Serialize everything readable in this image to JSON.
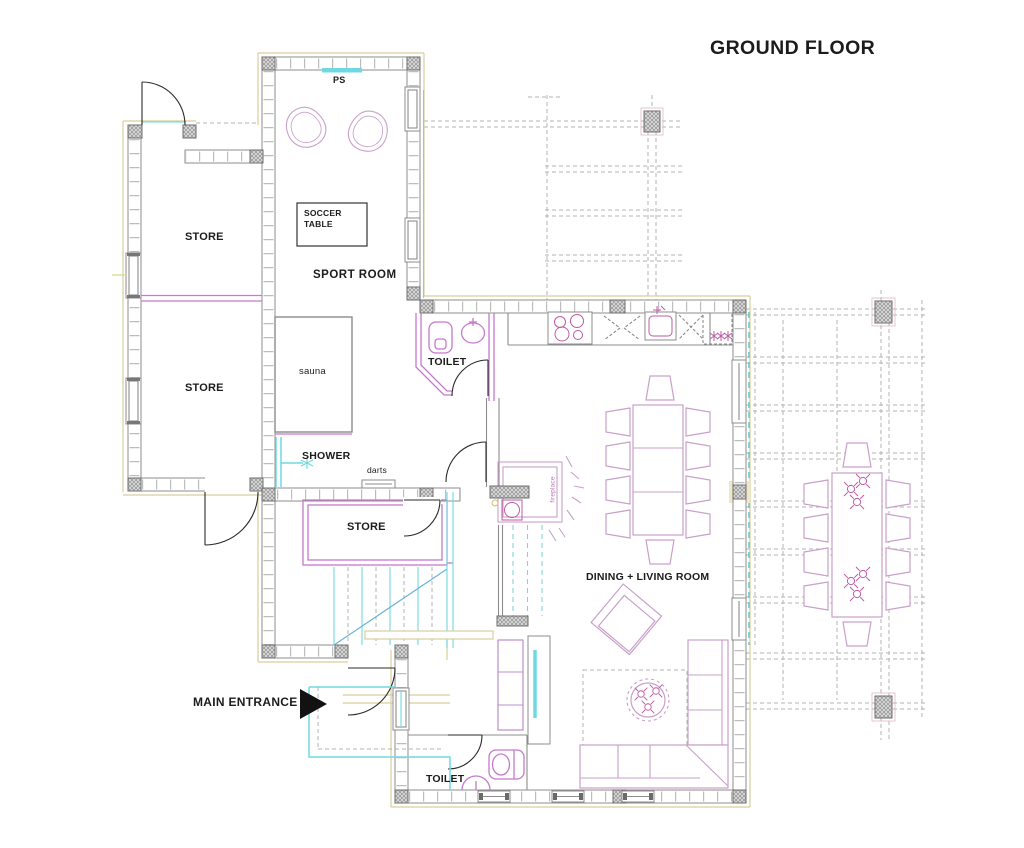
{
  "title": "GROUND FLOOR",
  "rooms": {
    "sport_room": "SPORT ROOM",
    "store_upper": "STORE",
    "store_middle": "STORE",
    "store_inner": "STORE",
    "sauna": "sauna",
    "toilet_upper": "TOILET",
    "toilet_lower": "TOILET",
    "dining_living": "DINING + LIVING ROOM"
  },
  "annotations": {
    "ps": "PS",
    "soccer_table": "SOCCER TABLE",
    "shower": "SHOWER",
    "darts": "darts",
    "fireplace": "fireplace",
    "main_entrance": "MAIN ENTRANCE"
  },
  "colors": {
    "wall": "#8c8c8c",
    "hatch": "#9a9a9a",
    "accent_tan": "#d9ce9c",
    "accent_cyan": "#6fd8e2",
    "teal": "#3db8c4",
    "magenta": "#c678ce",
    "furniture_pink": "#c9a0c9",
    "detail_pink": "#bf5aa5",
    "dash_gray": "#b3b3b3",
    "text": "#1c1c1c"
  }
}
